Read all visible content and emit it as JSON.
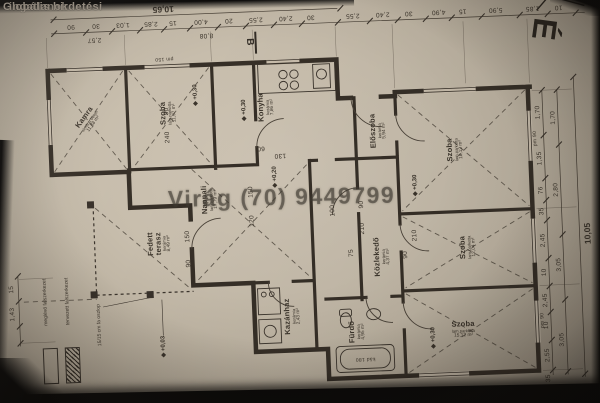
{
  "watermark": {
    "site1": "Globális hirdetési",
    "site2": "ingatlanok",
    "phone": "Virág (70) 9449799"
  },
  "north_label": "É",
  "section_label": "B",
  "legend": {
    "existing": "meglévő falszerkezet",
    "planned": "tervezett falszerkezet"
  },
  "note_column": "15/15 cm fa oszlop",
  "rooms": {
    "kamra": {
      "name": "Kamra",
      "finish": "simított beton",
      "area": "11,88 m²"
    },
    "szoba_left": {
      "name": "Szoba",
      "finish": "lam.parketta",
      "area": "11,97 m²"
    },
    "konyha": {
      "name": "Konyha",
      "finish": "kerámia",
      "area": "7,86 m²"
    },
    "nappali": {
      "name": "Nappali",
      "finish": "lam.parketta",
      "area": "17,79 m²"
    },
    "eloszoba": {
      "name": "Előszoba",
      "finish": "kerámia",
      "area": "5,94 m²"
    },
    "kozlekedo": {
      "name": "Közlekedő",
      "finish": "kerámia",
      "area": "4,37 m²"
    },
    "kazanhaz": {
      "name": "Kazánház",
      "finish": "kerámia",
      "area": "2,43 m²"
    },
    "furdo": {
      "name": "Fürdő",
      "finish": "kerámia",
      "area": "4,95 m²"
    },
    "terasz": {
      "name": "Fedett terasz",
      "finish": "kerámia",
      "area": "8,49 m²"
    },
    "szoba_tr": {
      "name": "Szoba",
      "finish": "lam.parketta",
      "area": "18,12 m²"
    },
    "szoba_mr": {
      "name": "Szoba",
      "finish": "lam.parketta",
      "area": "12,04 m²"
    },
    "szoba_br": {
      "name": "Szoba",
      "finish": "lam.parketta",
      "area": "15,12 m²"
    }
  },
  "levels": {
    "a": "+0,30",
    "b": "+0,20",
    "c": "+0,30",
    "d": "+0,30",
    "e": "+0,03",
    "f": "+0,30"
  },
  "dims": {
    "top_total": "10,65",
    "top_sub": "8,08",
    "top_left_seg": "2,57",
    "top_row": [
      "90",
      "30",
      "1,03",
      "2,85",
      "15",
      "4,00",
      "20",
      "2,55",
      "2,40",
      "30",
      "2,55",
      "2,40",
      "30",
      "4,90",
      "15",
      "5,90",
      "1,85",
      "10",
      "35"
    ],
    "right_inner": [
      "1,70",
      "1,35",
      "76",
      "35",
      "2,45",
      "10",
      "2,45",
      "10",
      "2,55",
      "35"
    ],
    "right_mid": [
      "1,70",
      "2,80",
      "3,05",
      "3,05"
    ],
    "right_outer": "10,05",
    "left_col": [
      "15",
      "1,43"
    ],
    "interior": [
      "240",
      "90",
      "150",
      "120",
      "210",
      "90",
      "75",
      "60",
      "130",
      "100",
      "90",
      "210",
      "pm 90",
      "pm 90",
      "pm 150",
      "kád 180",
      "150",
      "90"
    ]
  }
}
